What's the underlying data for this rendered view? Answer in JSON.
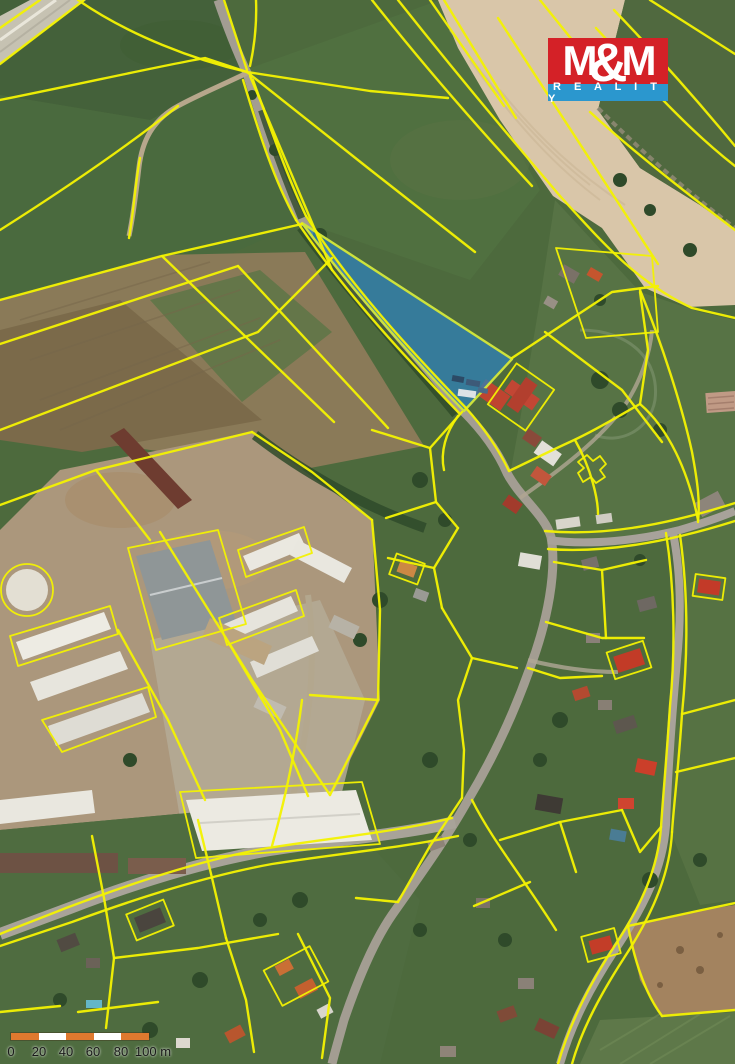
{
  "page": {
    "width_px": 735,
    "height_px": 1064,
    "kind": "aerial-photo-with-cadastral-overlay"
  },
  "map": {
    "parcel_line_color": "#f3f103",
    "highlighted_parcel": {
      "fill": "#2f80b5",
      "outline": "#cde23c",
      "shape": "triangular plot along road"
    },
    "scale_bar": {
      "labels": [
        "0",
        "20",
        "40",
        "60",
        "80",
        "100 m"
      ],
      "segment_color": "#e0792f",
      "segment_alt_color": "#ffffff",
      "text_color": "#1a1a1a"
    }
  },
  "logo": {
    "m_left": "M",
    "ampersand": "&",
    "m_right": "M",
    "reality": "R E A L I T Y",
    "red": "#d42127",
    "blue": "#2b97ce",
    "text_color": "#ffffff"
  }
}
